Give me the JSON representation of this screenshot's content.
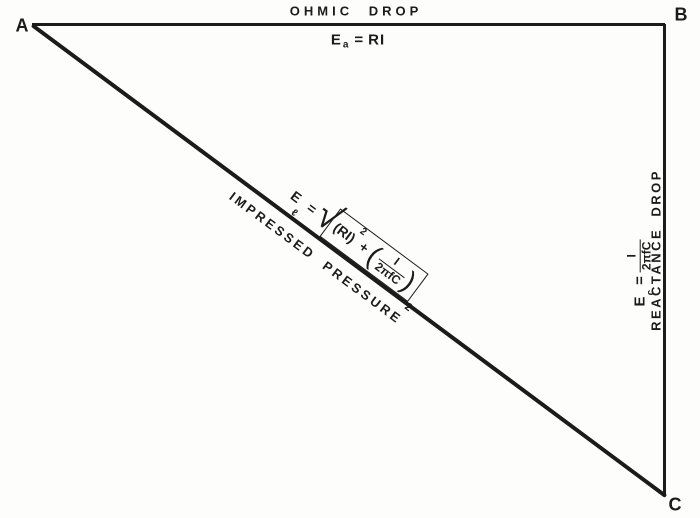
{
  "colors": {
    "ink": "#1b1b1b",
    "paper": "#fdfdfb"
  },
  "vertices": {
    "top_left": "A",
    "top_right": "B",
    "bottom_right": "C"
  },
  "top_side": {
    "label": "OHMIC DROP",
    "formula": {
      "base": "E",
      "sub": "a",
      "equals": "=",
      "rhs": "RI"
    }
  },
  "right_side": {
    "label": "REACTANCE DROP",
    "formula": {
      "base": "E",
      "sub": "c",
      "equals": "=",
      "numerator": "I",
      "denominator": "2πfC"
    }
  },
  "hypotenuse": {
    "label": "IMPRESSED PRESSURE",
    "formula": {
      "base": "E",
      "sub": "ℓ",
      "equals": "=",
      "radical": "√",
      "term1": "(RI)",
      "term1_exp": "2",
      "operator": "+",
      "open_paren": "(",
      "numerator": "I",
      "denominator": "2πfC",
      "close_paren": ")",
      "outer_exp": "2"
    }
  }
}
